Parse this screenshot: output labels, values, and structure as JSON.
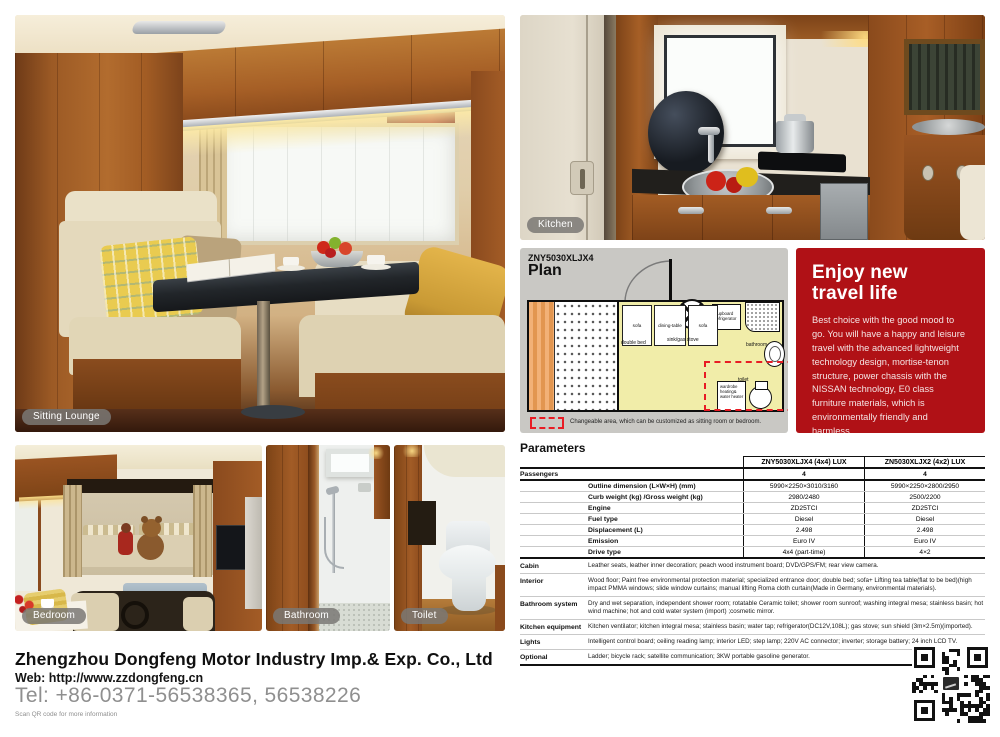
{
  "photos": {
    "lounge_label": "Sitting Lounge",
    "kitchen_label": "Kitchen",
    "bedroom_label": "Bedroom",
    "bathroom_label": "Bathroom",
    "toilet_label": "Toilet"
  },
  "plan": {
    "model": "ZNY5030XLJX4",
    "title": "Plan",
    "labels": {
      "double_bed": "double bed",
      "sink_gas_stove": "sink/gas stove",
      "cupboard_refrigerator": "cupboard refrigerator",
      "bathroom": "bathroom",
      "sofa_left": "sofa",
      "dining_table": "dining-table",
      "sofa_right": "sofa",
      "wardrobe": "wardrobe heating& water heater",
      "toilet": "toilet"
    },
    "legend": "Changeable area, which can be customized as sitting room or bedroom."
  },
  "promo": {
    "title_line1": "Enjoy new",
    "title_line2": "travel life",
    "body": "Best choice with the good mood to go. You will have a happy and leisure travel with the advanced lightweight technology design, mortise-tenon structure, power chassis with the NISSAN technology, E0 class furniture materials, which is environmentally friendly and harmless.",
    "accent_color": "#b01116"
  },
  "parameters": {
    "title": "Parameters",
    "columns": [
      "ZNY5030XLJX4 (4x4) LUX",
      "ZN5030XLJX2 (4x2) LUX"
    ],
    "passengers": {
      "label": "Passengers",
      "v1": "4",
      "v2": "4"
    },
    "specs": [
      {
        "label": "Outline dimension (L×W×H) (mm)",
        "v1": "5990×2250×3010/3160",
        "v2": "5990×2250×2800/2950"
      },
      {
        "label": "Curb weight (kg) /Gross weight (kg)",
        "v1": "2980/2480",
        "v2": "2500/2200"
      },
      {
        "label": "Engine",
        "v1": "ZD25TCI",
        "v2": "ZD25TCI"
      },
      {
        "label": "Fuel type",
        "v1": "Diesel",
        "v2": "Diesel"
      },
      {
        "label": "Displacement (L)",
        "v1": "2.498",
        "v2": "2.498"
      },
      {
        "label": "Emission",
        "v1": "Euro IV",
        "v2": "Euro IV"
      },
      {
        "label": "Drive type",
        "v1": "4x4 (part-time)",
        "v2": "4×2"
      }
    ],
    "features": [
      {
        "label": "Cabin",
        "text": "Leather seats, leather inner decoration; peach wood instrument board; DVD/GPS/FM; rear view camera."
      },
      {
        "label": "Interior",
        "text": "Wood floor; Paint free environmental protection material; specialized entrance door; double bed; sofa+ Lifting tea table(flat to be bed)(high impact PMMA windows; slide window curtains; manual lifting Roma cloth curtain(Made in Germany, environmental materials)."
      },
      {
        "label": "Bathroom system",
        "text": "Dry and wet separation, independent shower room; rotatable Ceramic toilet; shower room sunroof; washing integral mesa; stainless basin; hot wind machine; hot and cold water system (import) ;cosmetic mirror."
      },
      {
        "label": "Kitchen equipment",
        "text": "Kitchen ventilator; kitchen integral mesa; stainless basin; water tap; refrigerator(DC12V,108L); gas stove; sun shield (3m×2.5m)(imported)."
      },
      {
        "label": "Lights",
        "text": "Intelligent control board; ceiling reading lamp; interior LED; step lamp; 220V AC connector; inverter; storage battery; 24 inch LCD TV."
      },
      {
        "label": "Optional",
        "text": "Ladder; bicycle rack; satellite communication; 3KW portable gasoline generator."
      }
    ]
  },
  "footer": {
    "company": "Zhengzhou Dongfeng Motor Industry Imp.& Exp. Co., Ltd",
    "web": "Web: http://www.zzdongfeng.cn",
    "tel": "Tel: +86-0371-56538365, 56538226",
    "scan_note": "Scan QR code for more information"
  }
}
